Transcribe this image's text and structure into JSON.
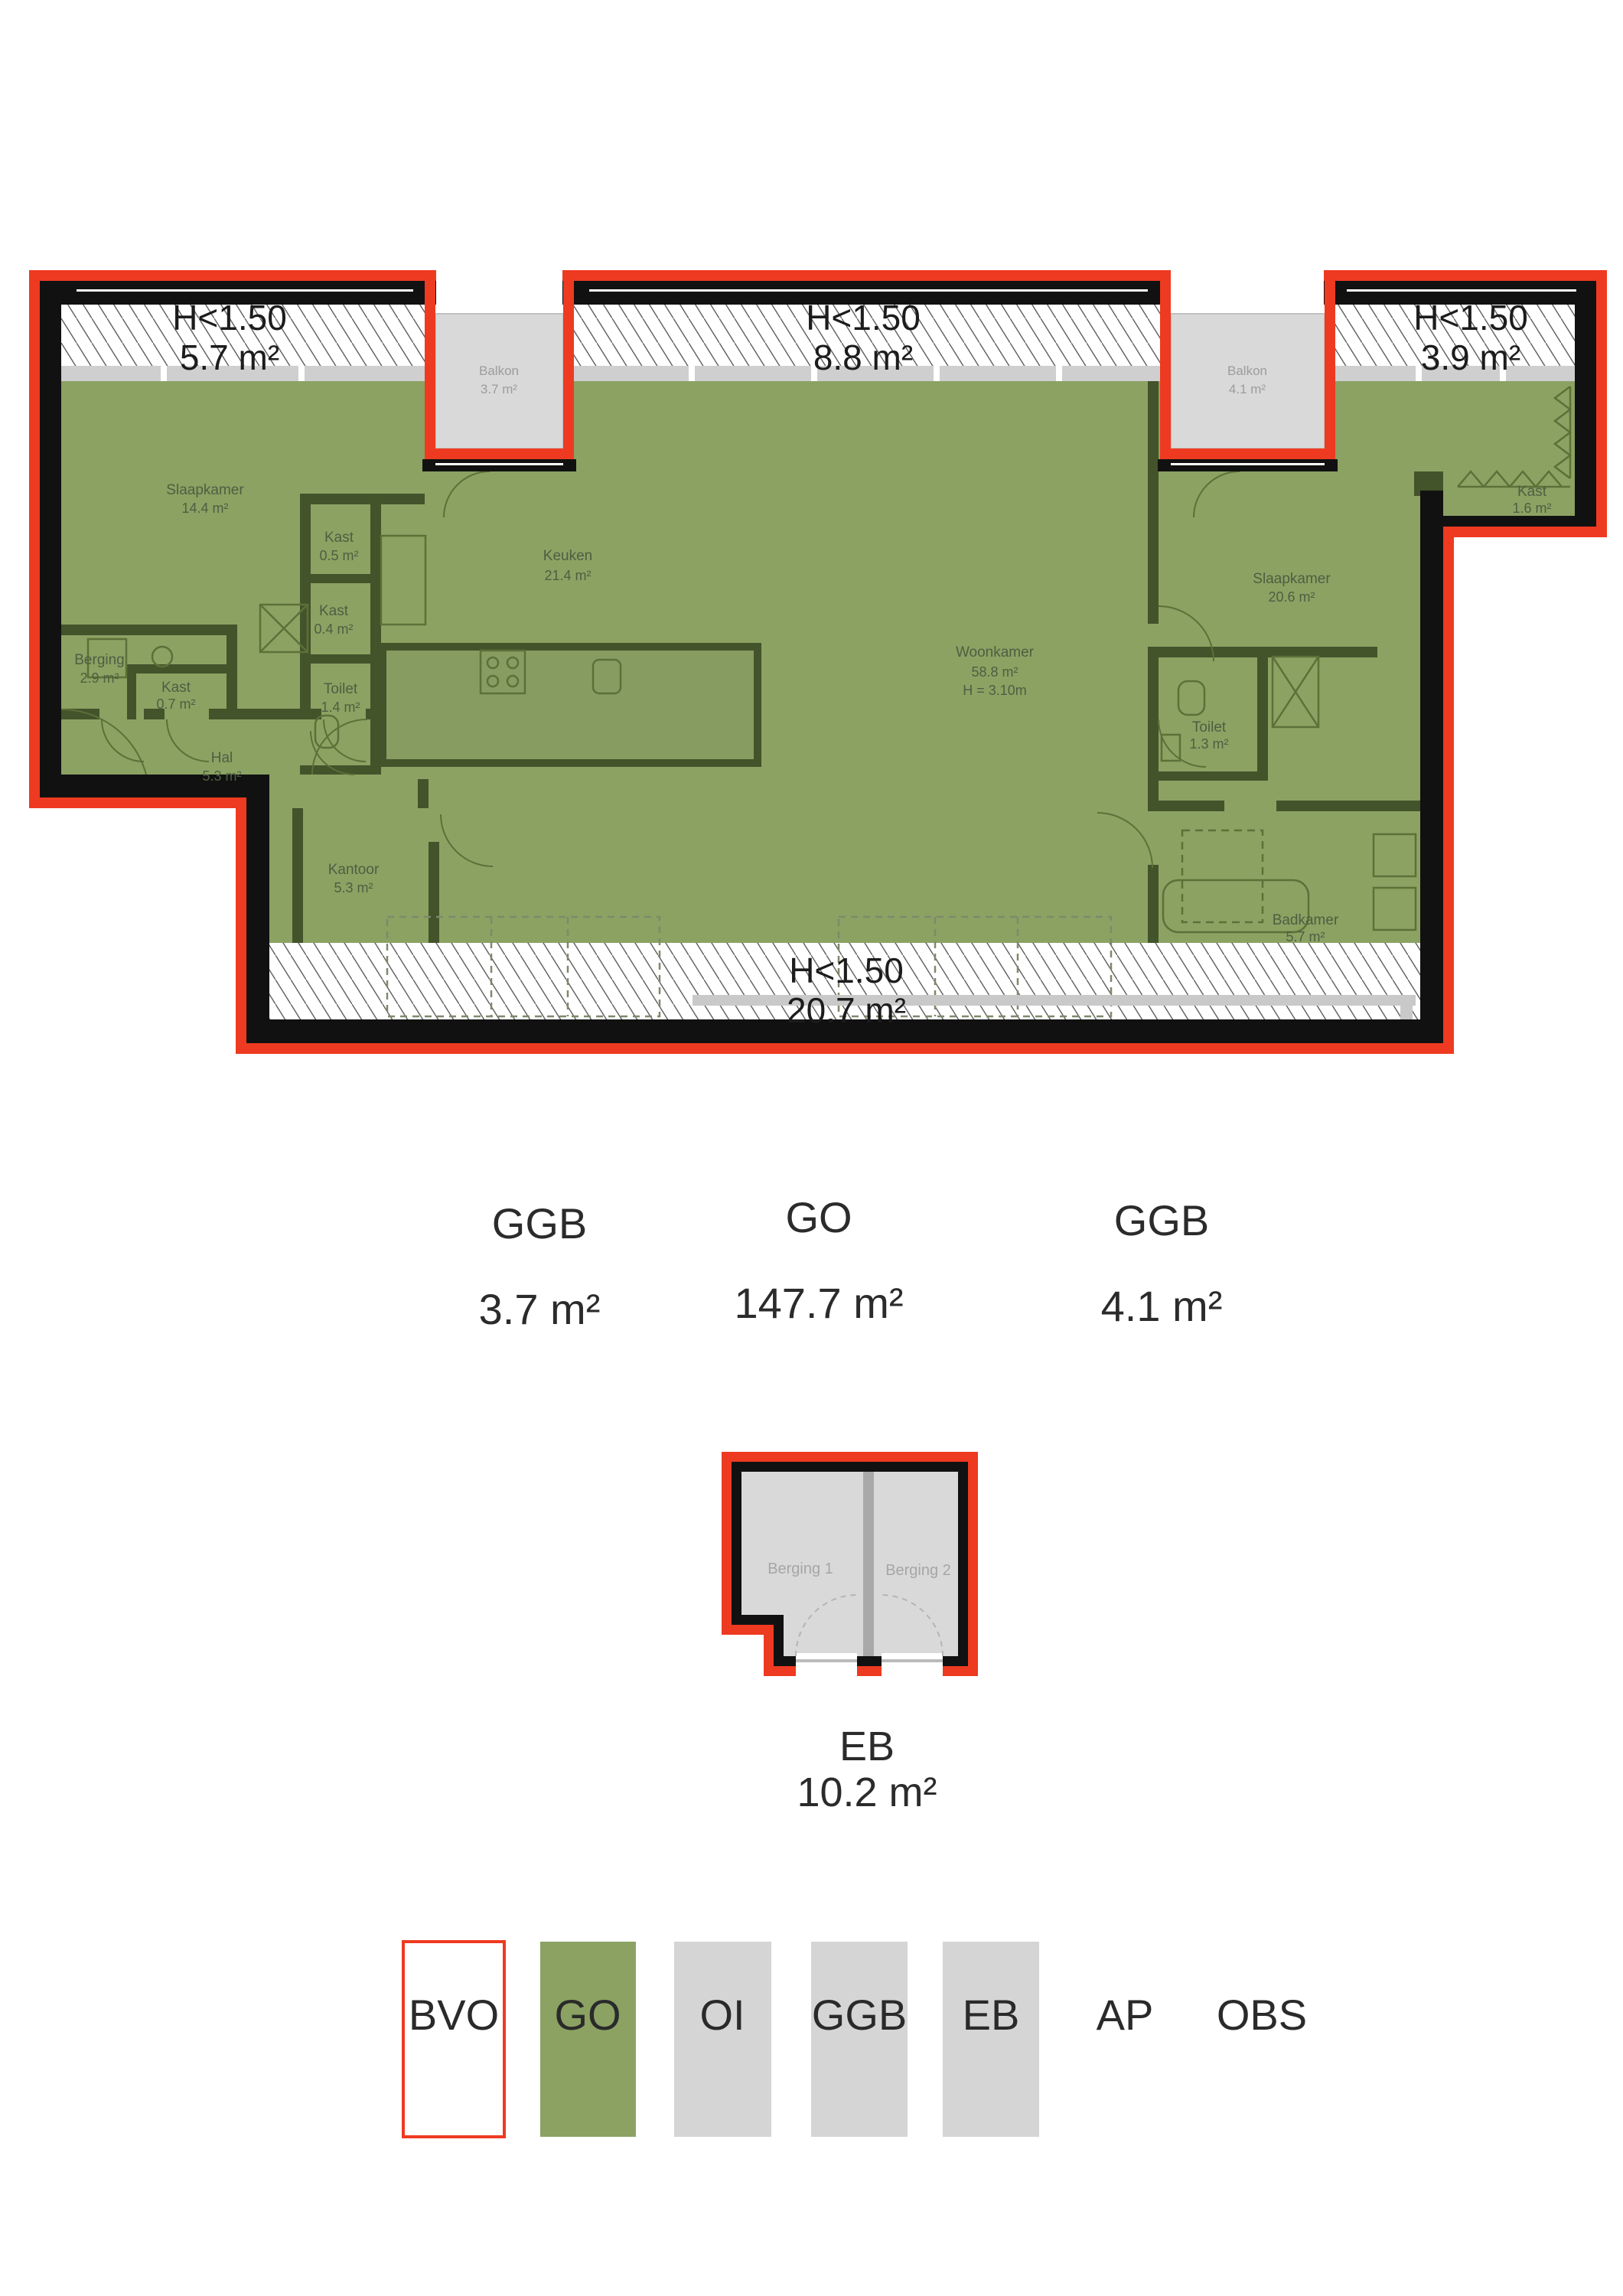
{
  "colors": {
    "bvo_red": "#ee3a21",
    "go_green": "#8ba263",
    "wall_black": "#111111",
    "wall_olive": "#43532a",
    "balkon_gray": "#d9d9d9",
    "legend_gray": "#d5d5d5",
    "room_label_green": "#4f5e42",
    "text_dark": "#2b2b2b"
  },
  "plan": {
    "hatch_zones": [
      {
        "label": "H<1.50",
        "area": "5.7 m²"
      },
      {
        "label": "H<1.50",
        "area": "8.8 m²"
      },
      {
        "label": "H<1.50",
        "area": "3.9 m²"
      },
      {
        "label": "H<1.50",
        "area": "20.7 m²"
      }
    ],
    "balconies": [
      {
        "name": "Balkon",
        "area": "3.7 m²"
      },
      {
        "name": "Balkon",
        "area": "4.1 m²"
      }
    ],
    "rooms": [
      {
        "name": "Slaapkamer",
        "area": "14.4 m²"
      },
      {
        "name": "Kast",
        "area": "0.5 m²"
      },
      {
        "name": "Kast",
        "area": "0.4 m²"
      },
      {
        "name": "Berging",
        "area": "2.9 m²"
      },
      {
        "name": "Kast",
        "area": "0.7 m²"
      },
      {
        "name": "Toilet",
        "area": "1.4 m²"
      },
      {
        "name": "Hal",
        "area": "5.3 m²"
      },
      {
        "name": "Keuken",
        "area": "21.4 m²"
      },
      {
        "name": "Woonkamer",
        "area": "58.8 m²",
        "height": "H = 3.10m"
      },
      {
        "name": "Kantoor",
        "area": "5.3 m²"
      },
      {
        "name": "Slaapkamer",
        "area": "20.6 m²"
      },
      {
        "name": "Toilet",
        "area": "1.3 m²"
      },
      {
        "name": "Kast",
        "area": "1.6 m²"
      },
      {
        "name": "Badkamer",
        "area": "5.7 m²"
      }
    ]
  },
  "measurement_labels": [
    {
      "code": "GGB",
      "area": "3.7 m²"
    },
    {
      "code": "GO",
      "area": "147.7 m²"
    },
    {
      "code": "GGB",
      "area": "4.1 m²"
    }
  ],
  "storage_block": {
    "units": [
      {
        "name": "Berging 1"
      },
      {
        "name": "Berging 2"
      }
    ],
    "code": "EB",
    "area": "10.2 m²"
  },
  "legend": {
    "items": [
      {
        "label": "BVO",
        "swatch": "#ffffff"
      },
      {
        "label": "GO",
        "swatch": "#8ba263"
      },
      {
        "label": "OI",
        "swatch": "#d5d5d5"
      },
      {
        "label": "GGB",
        "swatch": "#d5d5d5"
      },
      {
        "label": "EB",
        "swatch": "#d5d5d5"
      },
      {
        "label": "AP",
        "swatch": "none"
      },
      {
        "label": "OBS",
        "swatch": "none"
      }
    ]
  }
}
